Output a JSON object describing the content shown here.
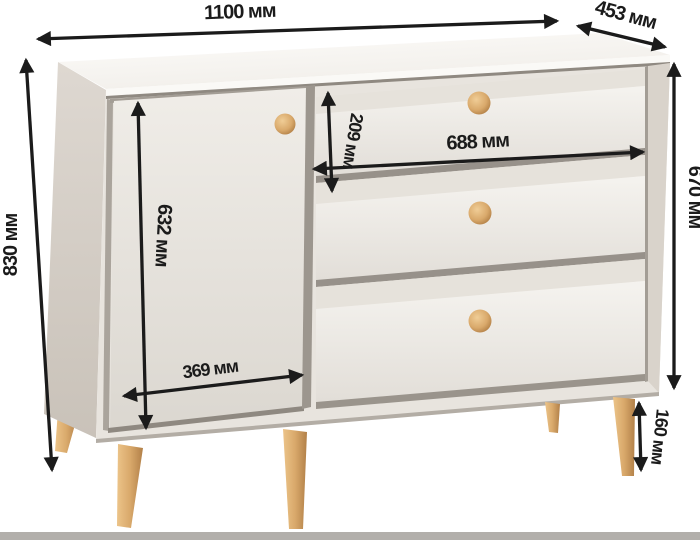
{
  "diagram": {
    "units": "мм",
    "labels": {
      "width": "1100 мм",
      "depth": "453 мм",
      "height": "830 мм",
      "side_height": "670 мм",
      "top_drawer_height": "209 мм",
      "drawer_width": "688 мм",
      "door_height": "632 мм",
      "door_width": "369 мм",
      "leg_height": "160 мм"
    },
    "values": {
      "width_mm": 1100,
      "depth_mm": 453,
      "height_mm": 830,
      "side_height_mm": 670,
      "top_drawer_height_mm": 209,
      "drawer_width_mm": 688,
      "door_height_mm": 632,
      "door_width_mm": 369,
      "leg_height_mm": 160
    },
    "colors": {
      "dimension_line": "#1b1b1b",
      "body_white": "#f2efeb",
      "side_panel": "#d6d0c8",
      "wood": "#d8a967",
      "floor": "#b2afab"
    }
  }
}
